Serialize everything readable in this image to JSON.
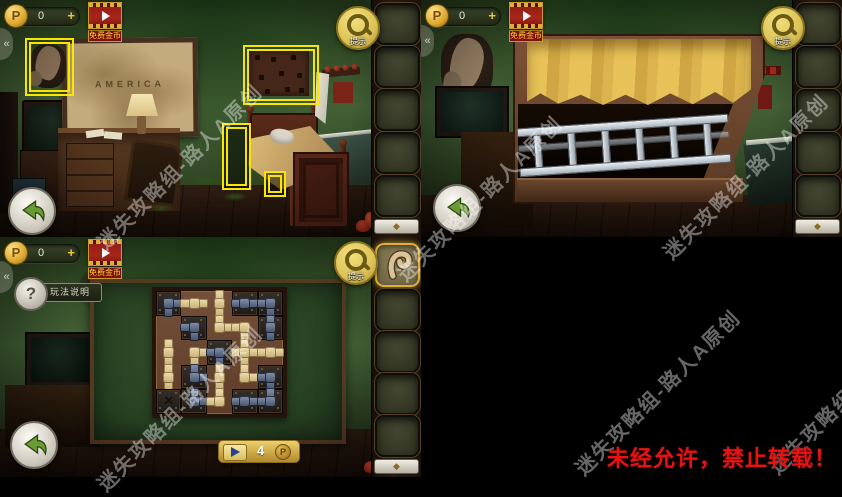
{
  "hud": {
    "coin_letter": "P",
    "coin_count": "0",
    "add_label": "+",
    "free_coins_label": "免费金币",
    "hint_label": "提示",
    "edge_arrow": "«",
    "inv_emblem": "◆"
  },
  "scene1": {
    "map_text": "AMERICA"
  },
  "puzzle": {
    "help_icon": "?",
    "help_label": "玩法说明",
    "skip_cost": "4",
    "skip_coin_letter": "P",
    "x_mark": "✕",
    "grid": [
      [
        "dark:blue:DR",
        "board:tan:LR",
        "board:tan:UD",
        "dark:blue:LR",
        "dark:blue:LD"
      ],
      [
        "",
        "dark:blue:DL",
        "board:tan:UR",
        "board:tan:LD",
        "dark:blue:UD"
      ],
      [
        "board:tan:UD",
        "board:tan:RD",
        "dark:blue:LD",
        "board:tan:UDLR",
        "board:tan:LR"
      ],
      [
        "board:tan:UD",
        "dark:blue:UR",
        "board:tan:UD",
        "board:tan:UR",
        "dark:blue:LD"
      ],
      [
        "x::",
        "dark:blue:UR",
        "board:tan:UL",
        "dark:blue:LR",
        "dark:blue:UL"
      ]
    ]
  },
  "watermark": {
    "text": "迷失攻略组-路人A原创"
  },
  "notice": {
    "text": "未经允许，禁止转载！"
  }
}
